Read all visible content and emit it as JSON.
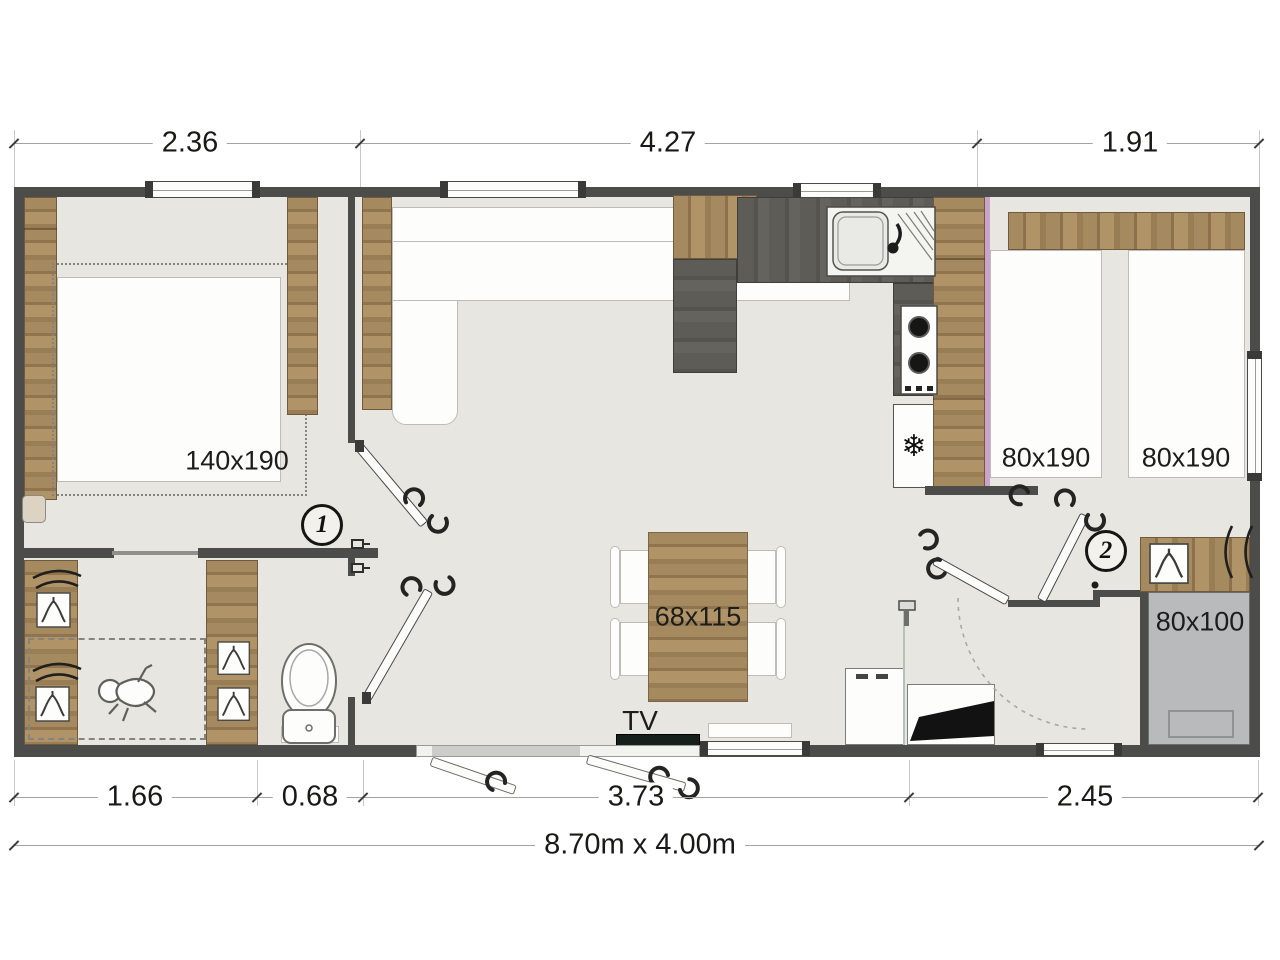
{
  "dimensions": {
    "top": [
      "2.36",
      "4.27",
      "1.91"
    ],
    "bottom": [
      "1.66",
      "0.68",
      "3.73",
      "2.45"
    ],
    "overall": "8.70m x 4.00m"
  },
  "labels": {
    "master_bed": "140x190",
    "single_bed_left": "80x190",
    "single_bed_right": "80x190",
    "dining_table": "68x115",
    "tv": "TV",
    "shower": "80x100"
  },
  "rooms": {
    "bedroom1_number": "1",
    "bedroom2_number": "2"
  },
  "icons": {
    "fridge_snowflake": "❄"
  },
  "colors": {
    "wall": "#4c4c4a",
    "floor": "#e7e6e1",
    "wood": "#a5895f",
    "counter": "#5d5c57",
    "shower_tile": "#b8babc",
    "accent_pink": "#c9a3c9"
  }
}
